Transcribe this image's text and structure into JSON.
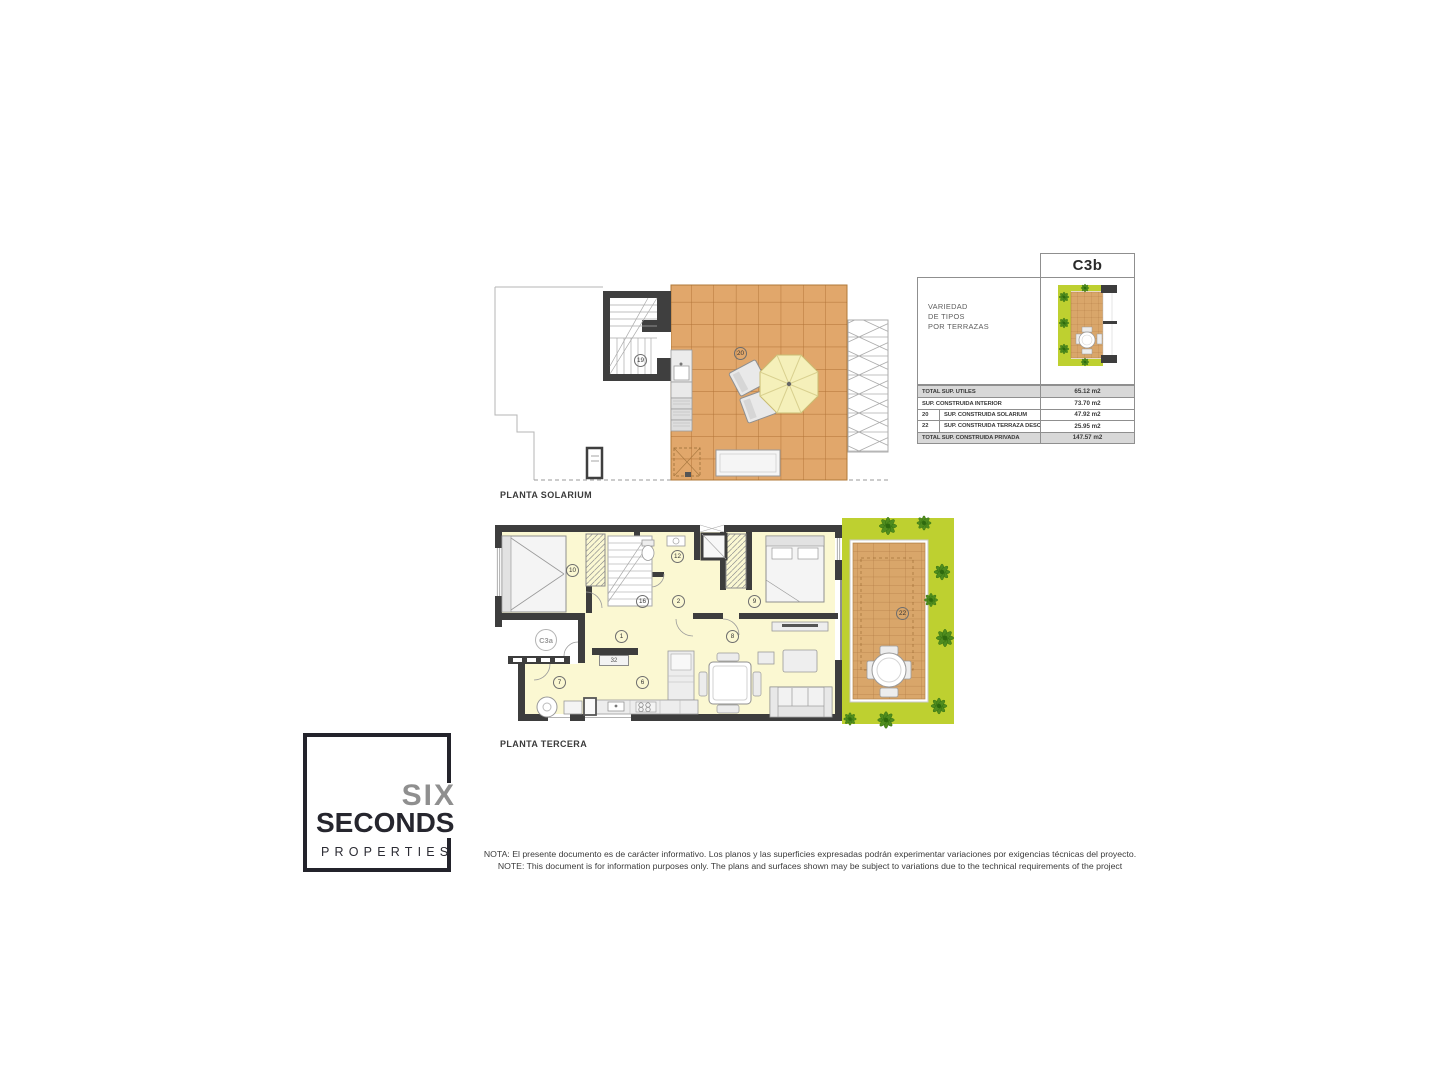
{
  "plans": {
    "solarium": {
      "title": "PLANTA SOLARIUM",
      "labels": {
        "stairwell": "19",
        "solarium": "20"
      }
    },
    "tercera": {
      "title": "PLANTA TERCERA",
      "unit": "C3a",
      "labels": {
        "n1": "1",
        "n2": "2",
        "n6": "6",
        "n7": "7",
        "n8": "8",
        "n9": "9",
        "n10": "10",
        "n12": "12",
        "n16": "16",
        "n22": "22",
        "n32": "32"
      }
    }
  },
  "legend": {
    "type_code": "C3b",
    "variety": [
      "VARIEDAD",
      "DE TIPOS",
      "POR TERRAZAS"
    ],
    "areas": {
      "rows": [
        {
          "num": "",
          "label": "TOTAL SUP. UTILES",
          "value": "65.12 m2"
        },
        {
          "num": "",
          "label": "SUP. CONSTRUIDA INTERIOR",
          "value": "73.70 m2"
        },
        {
          "num": "20",
          "label": "SUP. CONSTRUIDA SOLARIUM",
          "value": "47.92 m2"
        },
        {
          "num": "22",
          "label": "SUP. CONSTRUIDA TERRAZA DESCUBIERTA",
          "value": "25.95 m2"
        },
        {
          "num": "",
          "label": "TOTAL SUP. CONSTRUIDA PRIVADA",
          "value": "147.57 m2"
        }
      ]
    }
  },
  "logo": {
    "six": "SIX",
    "seconds": "SECONDS",
    "properties": "PROPERTIES"
  },
  "footnote": {
    "es": "NOTA: El presente documento es de carácter informativo. Los planos y las superficies expresadas podrán experimentar variaciones por exigencias técnicas del proyecto.",
    "en": "NOTE: This document is for information purposes only. The plans and surfaces shown may be subject to variations due to the technical requirements of the project"
  },
  "colors": {
    "wall": "#3d3d3d",
    "tile": "#e1a76b",
    "deck": "#d9a66a",
    "floor": "#fbf8d2",
    "planter_green": "#bed030",
    "brand_dark": "#23232b"
  }
}
